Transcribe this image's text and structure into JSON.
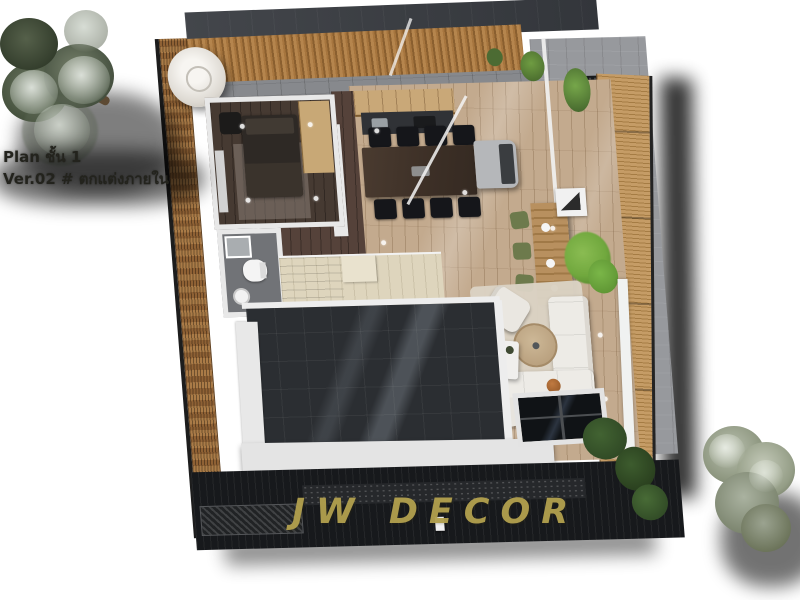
{
  "canvas": {
    "width": 800,
    "height": 600,
    "background": "#ffffff"
  },
  "caption": {
    "line1": "Plan ชั้น 1",
    "line2": "Ver.02 # ตกแต่งภายใน",
    "color": "#23231d"
  },
  "watermark": {
    "text": "JW DECOR",
    "color": "#b2a04e"
  },
  "palette": {
    "roof_dark": "#3a3d42",
    "wood_slat_band": "#b5854d",
    "left_wall_wood": "#aa7b47",
    "right_slat_wall": "#c59c66",
    "wood_floor": "#c3aa8e",
    "dark_wood_floor": "#55423a",
    "wall_white": "#e8e8e8",
    "void_floor": "#2b2e32",
    "terrace_paver": "#97999d",
    "rug_beige": "#dbd2c4",
    "sofa_white": "#edebe6",
    "dining_table": "#41332a",
    "stairs_beige": "#ded5bd",
    "plant_green": "#71a83e",
    "stool_green": "#6d7a4c",
    "deck_dark": "#17191c",
    "accent_orange": "#c07a41",
    "tank_white": "#f2f0ec"
  },
  "scene": {
    "type": "3d-top-down-floor-plan-render",
    "elements": [
      "pine-tree-top-left",
      "water-tank",
      "bedroom",
      "wardrobe",
      "bed",
      "desk",
      "bathroom",
      "shower",
      "toilet",
      "sink",
      "kitchen-cabinets",
      "kitchen-counter",
      "dining-table",
      "dining-chairs",
      "kitchen-island",
      "glass-roof-frames",
      "bar-console",
      "green-stools",
      "terrace-garden",
      "terrace-plant",
      "living-rug",
      "l-sofa",
      "armchairs",
      "round-coffee-table",
      "side-table",
      "orange-ball",
      "staircase",
      "double-height-void",
      "skylight",
      "rear-deck",
      "hatched-walkway",
      "shrubs",
      "tree-bottom-right"
    ]
  }
}
